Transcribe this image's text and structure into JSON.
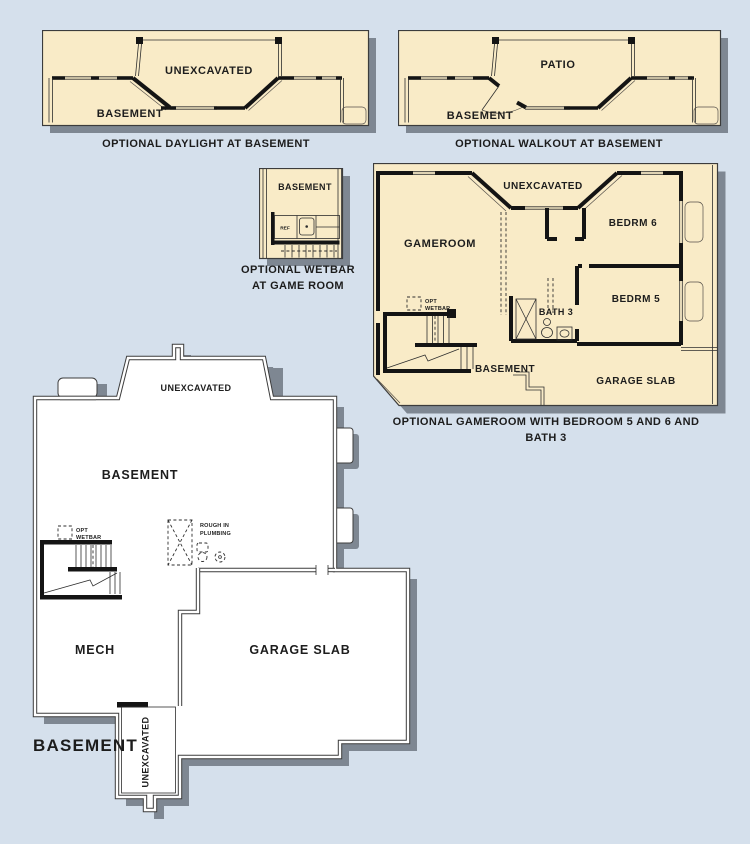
{
  "colors": {
    "background": "#d5e0ec",
    "plan_fill": "#f9ebc7",
    "shadow": "#7e8792",
    "wall": "#141414",
    "outline": "#3c3c3c",
    "floor_white": "#ffffff",
    "text": "#1d1d1d"
  },
  "panels": {
    "daylight": {
      "caption": "OPTIONAL DAYLIGHT AT BASEMENT",
      "labels": {
        "unexcavated": "UNEXCAVATED",
        "basement": "BASEMENT"
      }
    },
    "walkout": {
      "caption": "OPTIONAL WALKOUT AT BASEMENT",
      "labels": {
        "patio": "PATIO",
        "basement": "BASEMENT"
      }
    },
    "wetbar": {
      "caption_line1": "OPTIONAL WETBAR",
      "caption_line2": "AT GAME ROOM",
      "labels": {
        "basement": "BASEMENT",
        "ref": "REF"
      }
    },
    "gameroom": {
      "caption": "OPTIONAL GAMEROOM WITH BEDROOM 5 AND 6 AND BATH 3",
      "labels": {
        "gameroom": "GAMEROOM",
        "unexcavated": "UNEXCAVATED",
        "bedrm6": "BEDRM 6",
        "bedrm5": "BEDRM 5",
        "bath3": "BATH 3",
        "basement": "BASEMENT",
        "garage": "GARAGE SLAB",
        "opt": "OPT",
        "wetbar": "WETBAR"
      }
    },
    "main": {
      "title": "BASEMENT",
      "labels": {
        "unexcavated_bay": "UNEXCAVATED",
        "basement": "BASEMENT",
        "opt": "OPT",
        "wetbar": "WETBAR",
        "rough_line1": "ROUGH IN",
        "rough_line2": "PLUMBING",
        "mech": "MECH",
        "garage": "GARAGE SLAB",
        "unexcavated_porch": "UNEXCAVATED"
      }
    }
  }
}
